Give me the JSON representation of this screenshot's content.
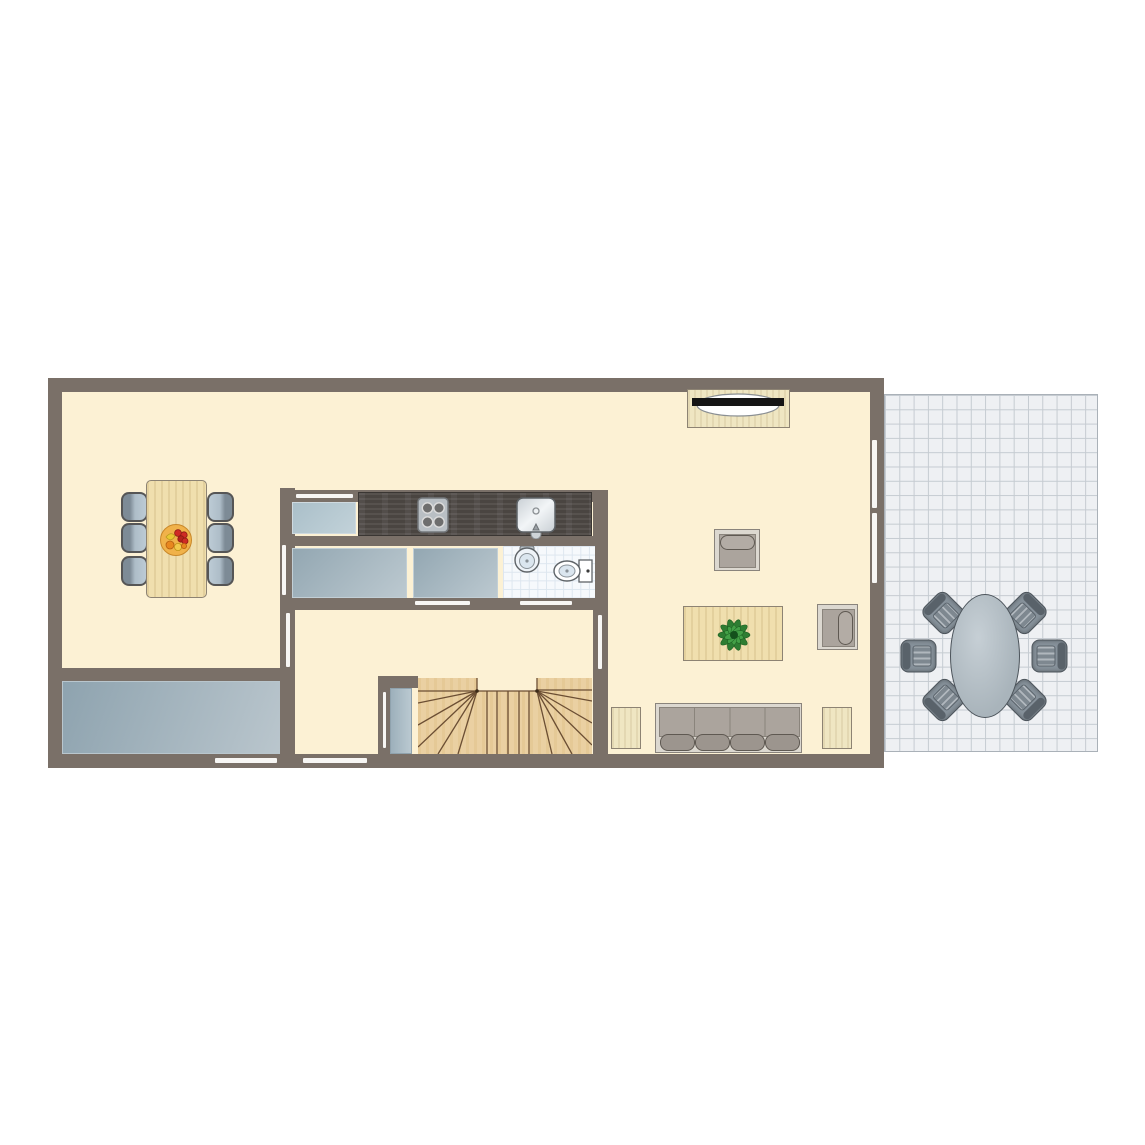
{
  "meta": {
    "type": "floor-plan",
    "view": "top-down",
    "text_labels": []
  },
  "colors": {
    "wall": "#7a7068",
    "floor": "#fcf1d4",
    "opening": "#f7f6f4",
    "patio_bg": "#eef0f3",
    "patio_line": "#c5cbd1",
    "patio_table": "#a9b4bb",
    "counter": "#4a4541",
    "wood_light": "#f0dfae",
    "plant_green": "#2e7d32",
    "fruit_bowl": "#f0b24a"
  },
  "rooms": [
    {
      "name": "dining-room"
    },
    {
      "name": "kitchen"
    },
    {
      "name": "bathroom"
    },
    {
      "name": "hallway-with-stairs"
    },
    {
      "name": "storage-room"
    },
    {
      "name": "living-room"
    },
    {
      "name": "patio-terrace"
    }
  ],
  "furniture": [
    {
      "name": "dining-table",
      "seats": 6,
      "item_on_top": "fruit-bowl"
    },
    {
      "name": "kitchen-counter",
      "appliances": [
        "stove-4-burner",
        "kitchen-sink"
      ]
    },
    {
      "name": "kitchen-cabinets",
      "count": 3
    },
    {
      "name": "bathroom-fixtures",
      "items": [
        "wash-basin",
        "toilet"
      ]
    },
    {
      "name": "staircase",
      "style": "u-shaped-winder"
    },
    {
      "name": "closet-door"
    },
    {
      "name": "tv-cabinet",
      "item_on_top": "television"
    },
    {
      "name": "armchair",
      "count": 2
    },
    {
      "name": "coffee-table",
      "item_on_top": "plant"
    },
    {
      "name": "sofa",
      "seats": 4
    },
    {
      "name": "side-table",
      "count": 2
    },
    {
      "name": "patio-table",
      "shape": "oval",
      "seats": 6
    }
  ]
}
